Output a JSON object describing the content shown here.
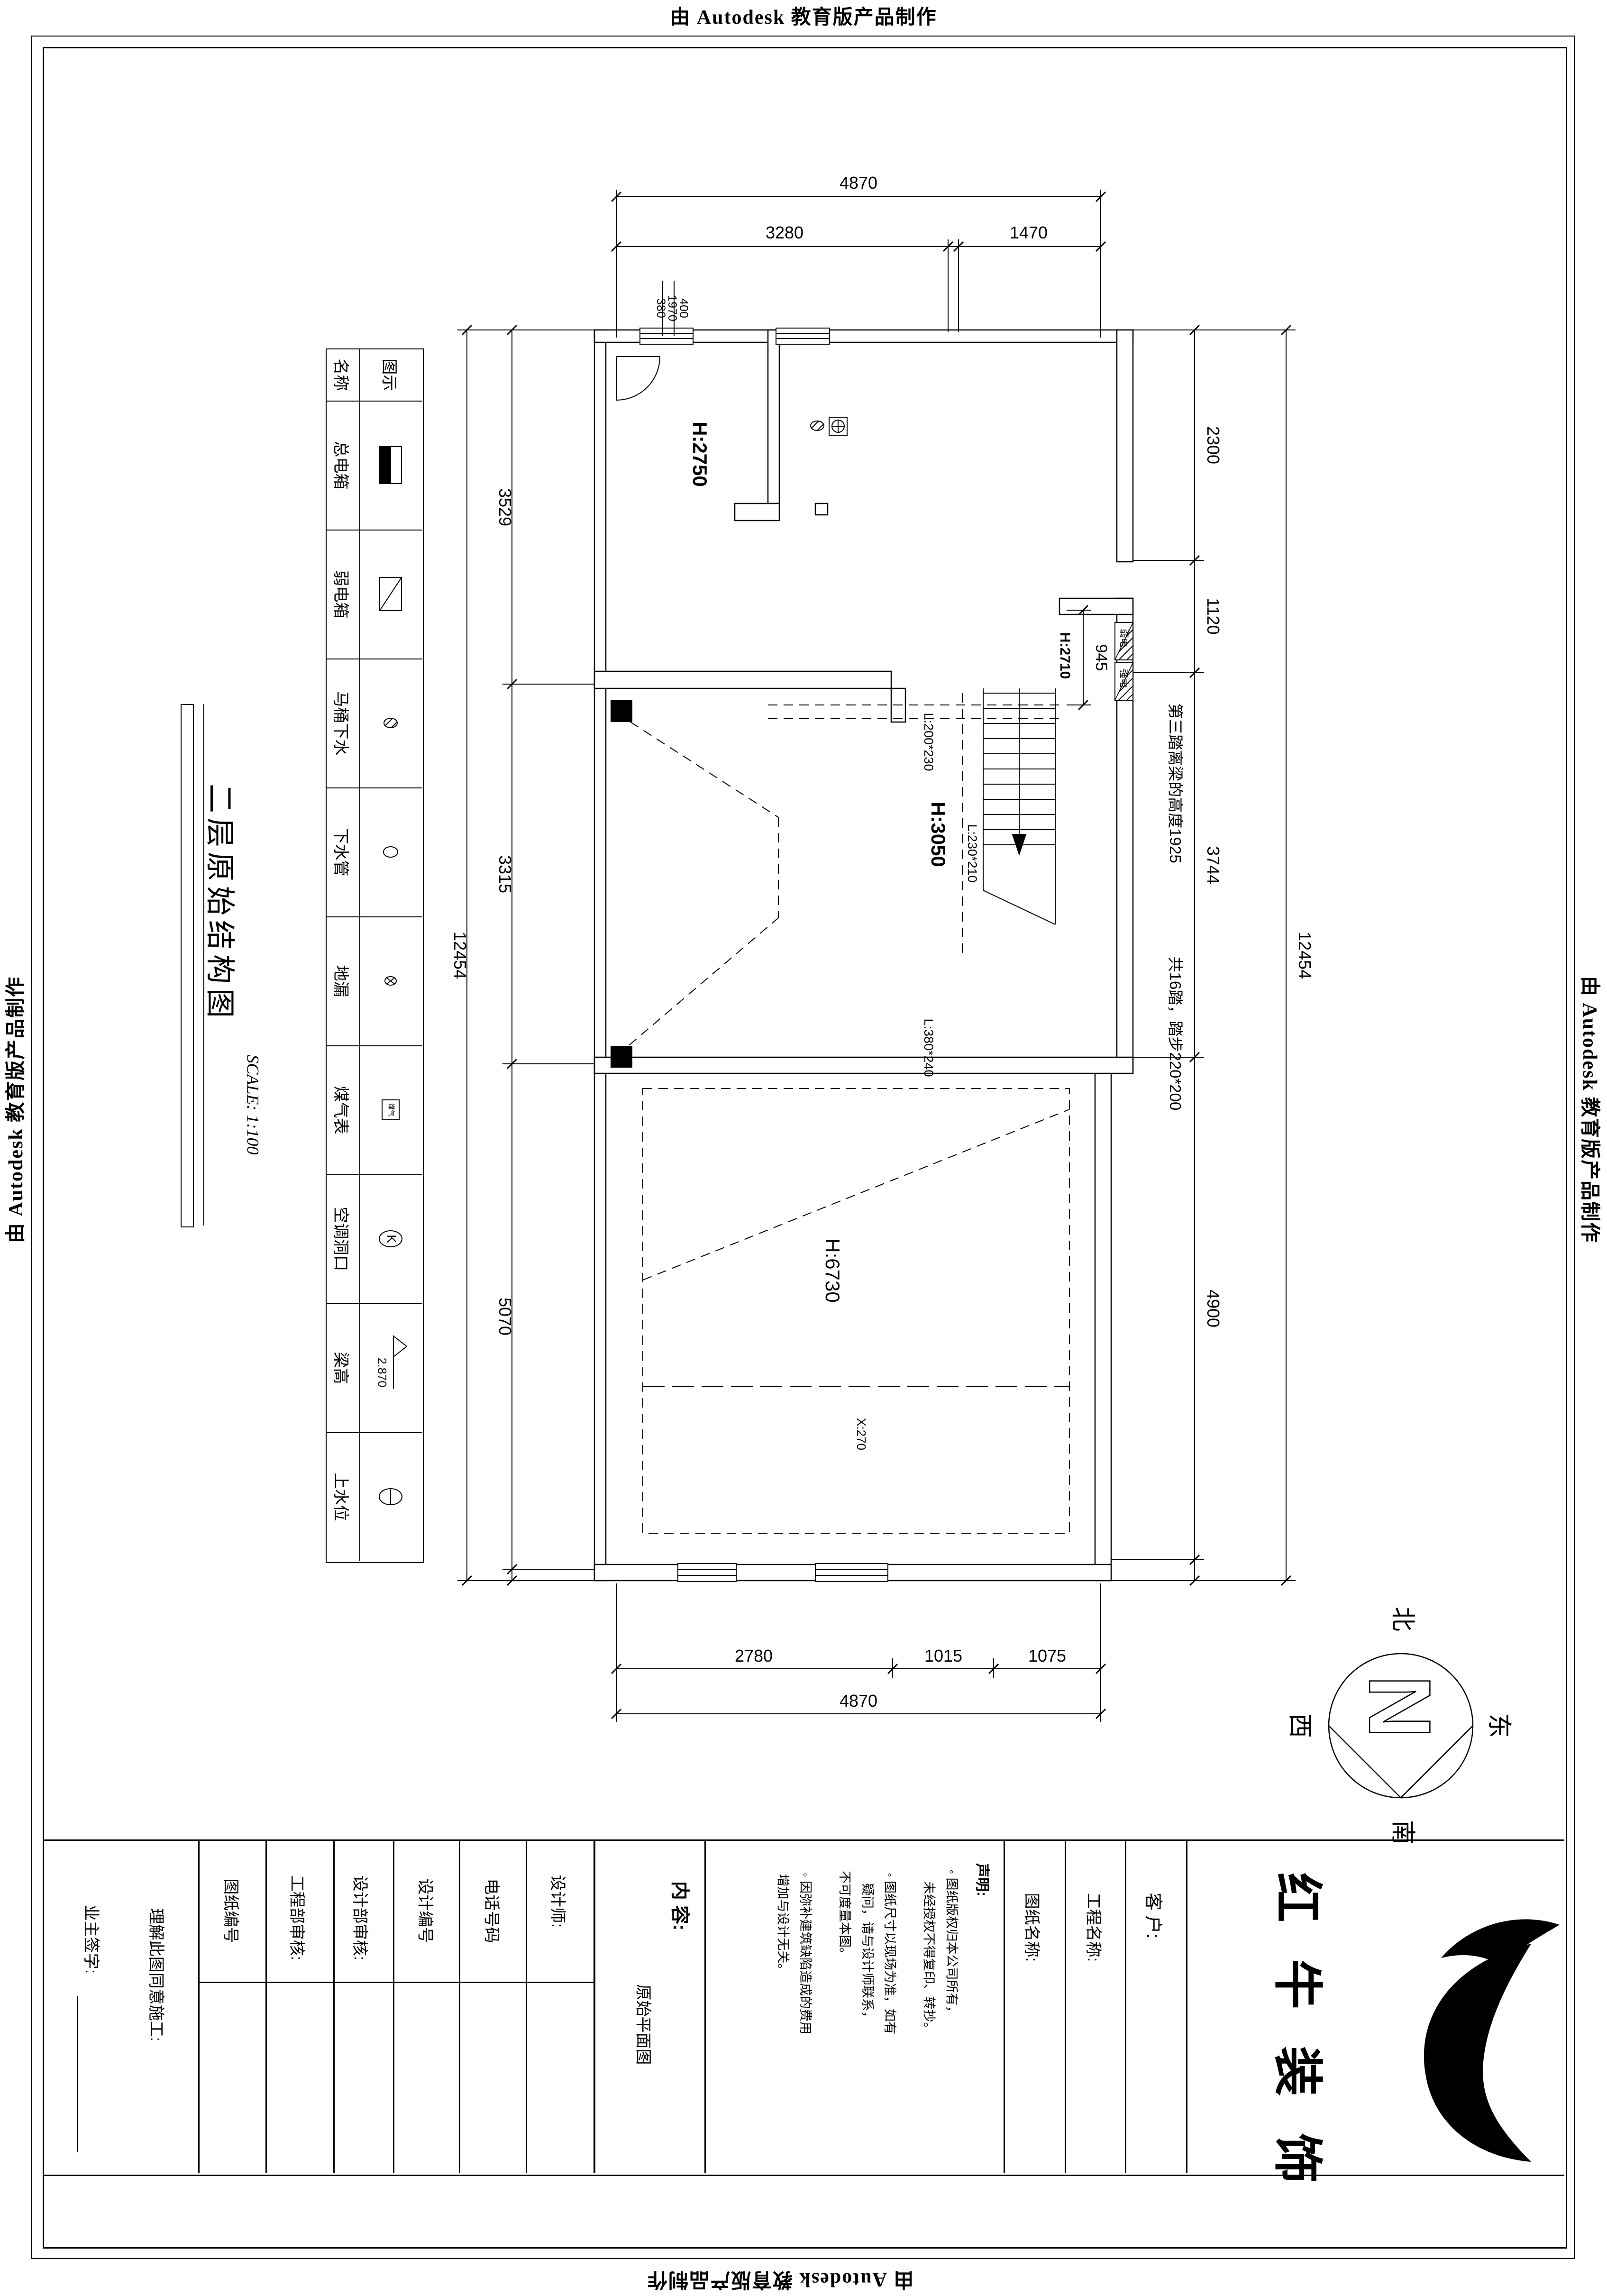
{
  "watermark": {
    "text": "由 Autodesk 教育版产品制作"
  },
  "title": {
    "text": "二层原始结构图",
    "scale": "SCALE: 1:100"
  },
  "legend": {
    "header": {
      "name": "名称",
      "symbol": "图示"
    },
    "rows": [
      {
        "name": "总电箱",
        "symbol": "main-electric-box"
      },
      {
        "name": "弱电箱",
        "symbol": "weak-electric-box"
      },
      {
        "name": "马桶下水",
        "symbol": "toilet-drain"
      },
      {
        "name": "下水管",
        "symbol": "drain-pipe"
      },
      {
        "name": "地漏",
        "symbol": "floor-drain"
      },
      {
        "name": "煤气表",
        "symbol": "gas-meter",
        "symbol_text": "煤气"
      },
      {
        "name": "空调洞口",
        "symbol": "ac-opening",
        "symbol_text": "K"
      },
      {
        "name": "梁高",
        "symbol": "beam-height",
        "symbol_text": "2.870"
      },
      {
        "name": "上水位",
        "symbol": "water-supply-level"
      }
    ]
  },
  "plan": {
    "rooms": {
      "h2750": "H:2750",
      "h3050": "H:3050",
      "h6730": "H:6730",
      "h2710": "H:2710",
      "x270": "X:270"
    },
    "beams": {
      "b1": "L:200*230",
      "b2": "L:230*210",
      "b3": "L:380*240"
    },
    "stairs": {
      "note1": "第三踏离梁的高度1925",
      "note2": "共16踏，踏步220*200"
    },
    "boxes": {
      "weak": "弱电",
      "strong": "强电"
    }
  },
  "dims": {
    "top_overall": "4870",
    "top_a": "3280",
    "top_b": "1470",
    "small_a": "380",
    "small_b": "1970",
    "small_c": "400",
    "left_a": "3529",
    "left_b": "3315",
    "left_c": "5070",
    "left_total": "12454",
    "right_a": "2300",
    "right_b": "1120",
    "right_c": "3744",
    "right_d": "4900",
    "right_total": "12454",
    "bottom_a": "2780",
    "bottom_b": "1015",
    "bottom_c": "1075",
    "bottom_overall": "4870",
    "v945": "945"
  },
  "compass": {
    "n": "N",
    "north": "北",
    "south": "南",
    "east": "东",
    "west": "西"
  },
  "titleblock": {
    "owner_sign": "业主签字:",
    "agree": "理解此图同意施工:",
    "drawing_no": "图纸编号",
    "eng_review": "工程部审核:",
    "design_review": "设计部审核:",
    "design_no": "设计编号",
    "phone": "电话号码",
    "designer": "设计师:",
    "content_label": "内 容:",
    "content_value": "原始平面图",
    "statement_title": "声明:",
    "statement_lines": [
      "◦ 图纸版权归本公司所有，",
      "未经授权不得复印、转抄。",
      "◦ 图纸尺寸以现场为准，如有",
      "疑问，请与设计师联系，",
      "不可度量本图。",
      "◦ 因弥补建筑缺陷造成的费用",
      "增加与设计无关。"
    ],
    "drawing_name": "图纸名称:",
    "project_name": "工程名称:",
    "client": "客 户:",
    "brand": "红 牛 装 饰"
  },
  "colors": {
    "ink": "#000000",
    "paper": "#ffffff"
  }
}
